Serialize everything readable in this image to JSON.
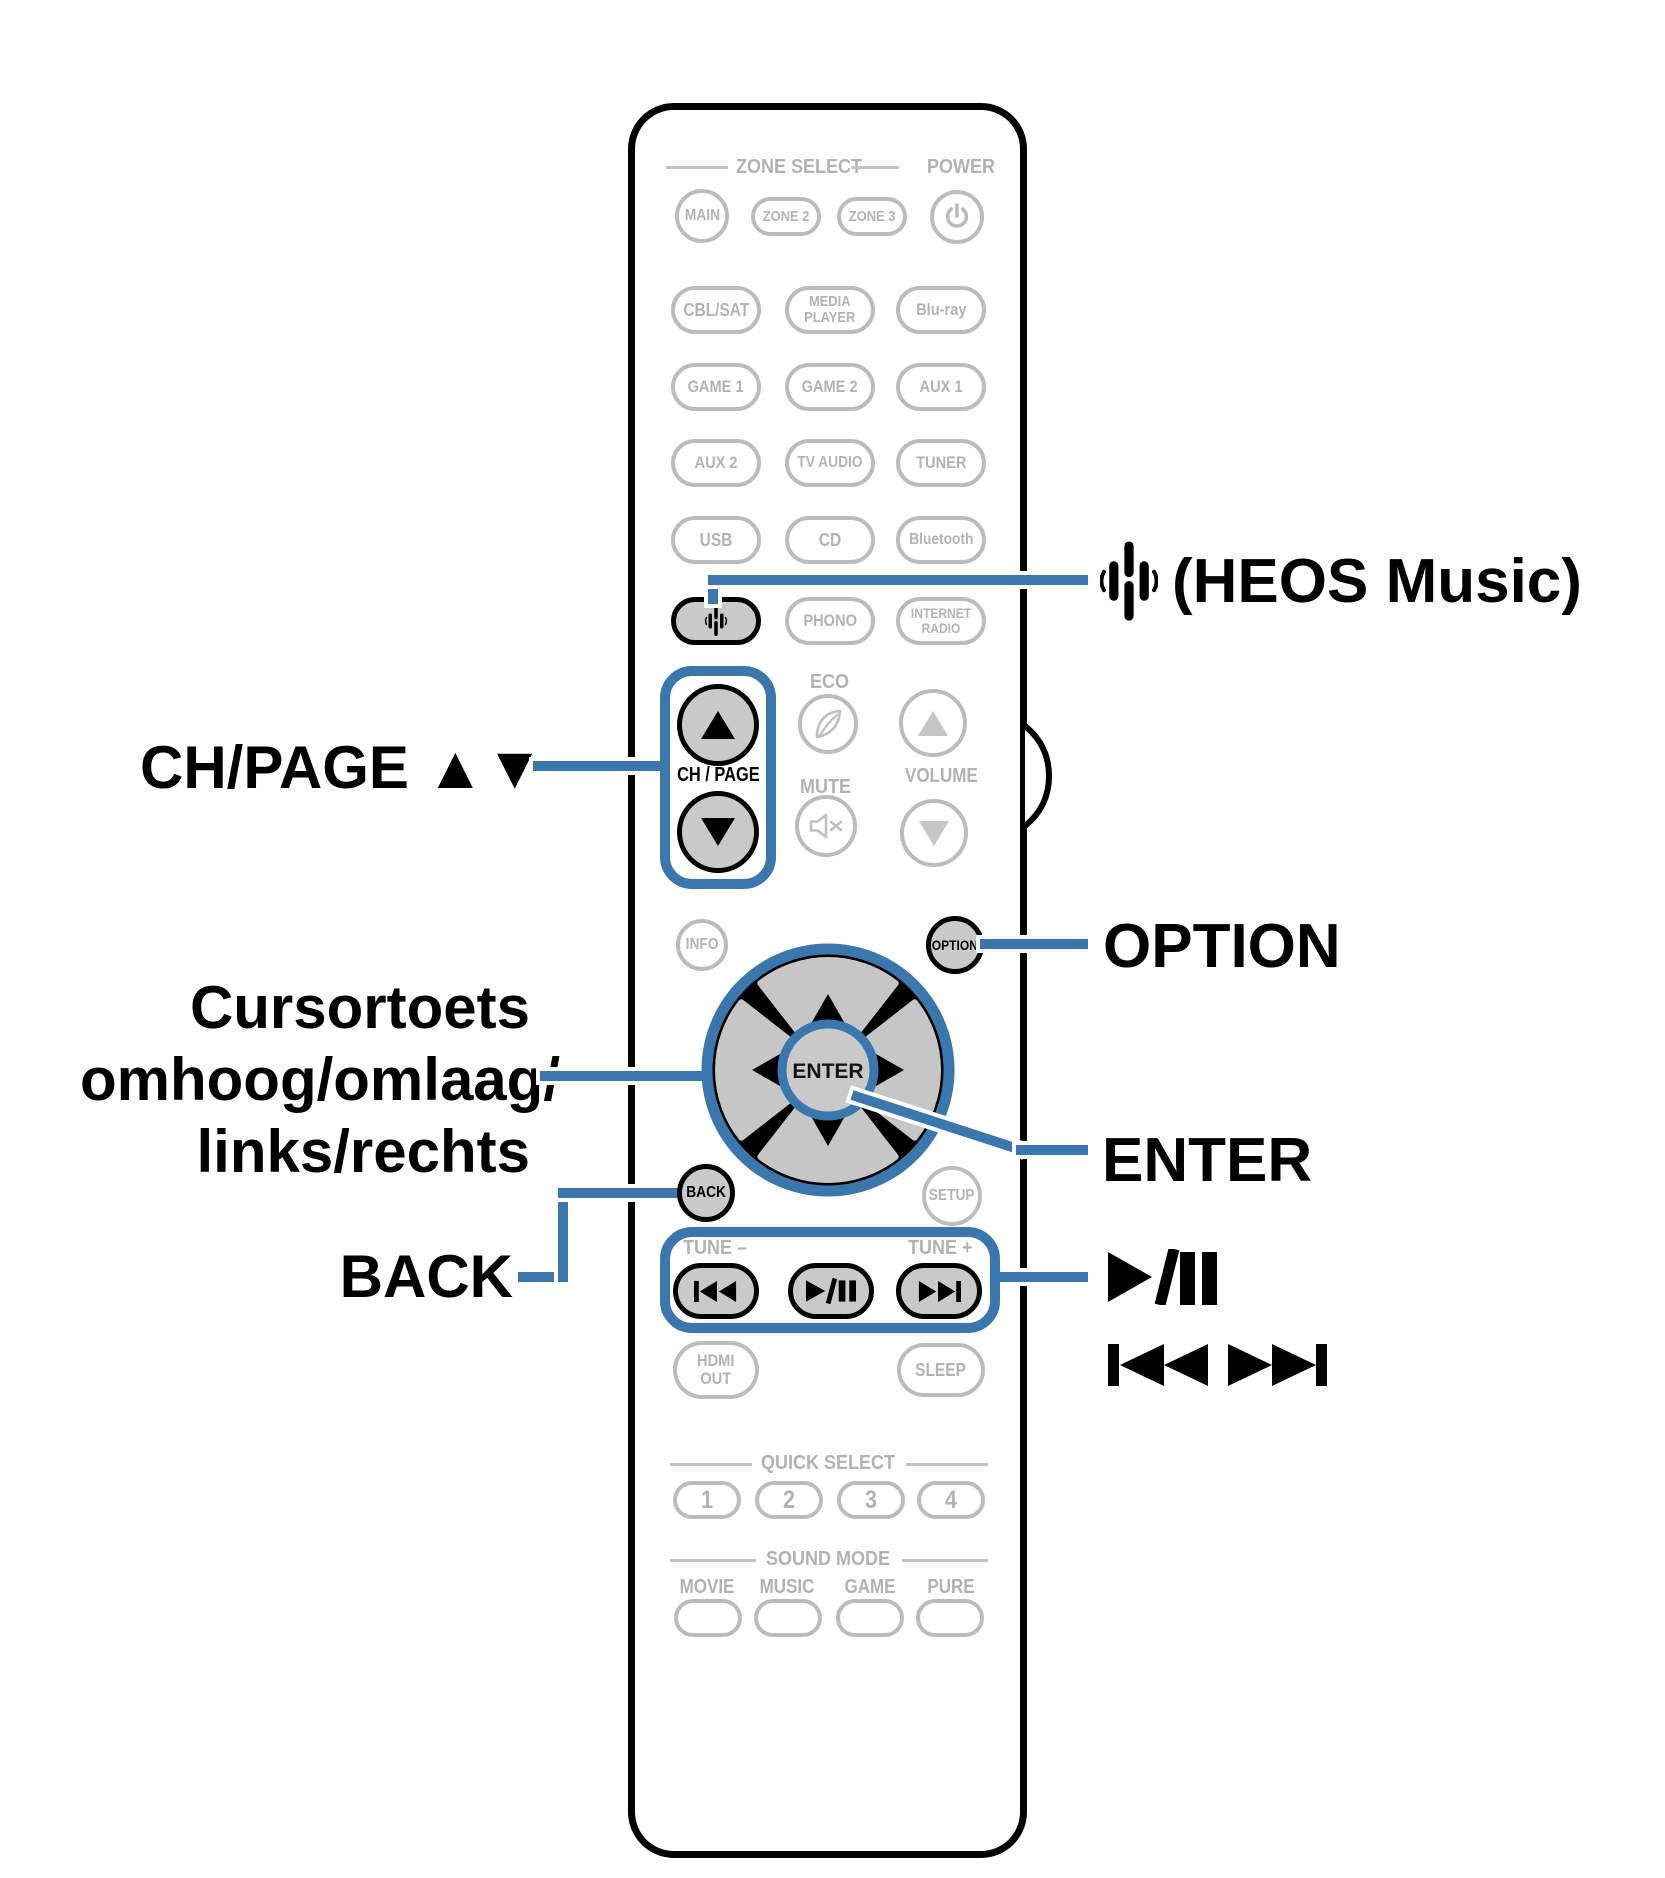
{
  "colors": {
    "callout_blue": "#3b76ad",
    "button_outline_gray": "#bcbcbc",
    "button_text_gray": "#b2b2b2",
    "highlight_button_fill": "#c9c9c9",
    "black": "#000000"
  },
  "labels": {
    "heos_music": "(HEOS Music)",
    "ch_page": "CH/PAGE ▲▼",
    "cursor_l1": "Cursortoets",
    "cursor_l2": "omhoog/omlaag/",
    "cursor_l3": "links/rechts",
    "back": "BACK",
    "option": "OPTION",
    "enter": "ENTER"
  },
  "icons": {
    "heos": "heos-sound-wave",
    "power": "power-symbol",
    "eco": "leaf",
    "mute": "speaker-x",
    "play_pause": "play-pause",
    "skip_back": "skip-back",
    "skip_forward": "skip-forward",
    "cursor_arrows": "up-down-left-right-triangles"
  },
  "remote": {
    "headers": {
      "zone_select": "ZONE SELECT",
      "power": "POWER",
      "eco": "ECO",
      "mute": "MUTE",
      "volume": "VOLUME",
      "ch_page": "CH / PAGE",
      "tune_minus": "TUNE –",
      "tune_plus": "TUNE +",
      "quick_select": "QUICK SELECT",
      "sound_mode": "SOUND MODE"
    },
    "buttons": {
      "main": "MAIN",
      "zone2": "ZONE 2",
      "zone3": "ZONE 3",
      "cbl_sat": "CBL/SAT",
      "media_player_1": "MEDIA",
      "media_player_2": "PLAYER",
      "bluray": "Blu-ray",
      "game1": "GAME 1",
      "game2": "GAME 2",
      "aux1": "AUX 1",
      "aux2": "AUX 2",
      "tv_audio": "TV AUDIO",
      "tuner": "TUNER",
      "usb": "USB",
      "cd": "CD",
      "bluetooth": "Bluetooth",
      "phono": "PHONO",
      "internet_radio_1": "INTERNET",
      "internet_radio_2": "RADIO",
      "info": "INFO",
      "option": "OPTION",
      "enter": "ENTER",
      "back": "BACK",
      "setup": "SETUP",
      "hdmi_out_1": "HDMI",
      "hdmi_out_2": "OUT",
      "sleep": "SLEEP",
      "q1": "1",
      "q2": "2",
      "q3": "3",
      "q4": "4",
      "movie": "MOVIE",
      "music": "MUSIC",
      "game": "GAME",
      "pure": "PURE"
    }
  }
}
